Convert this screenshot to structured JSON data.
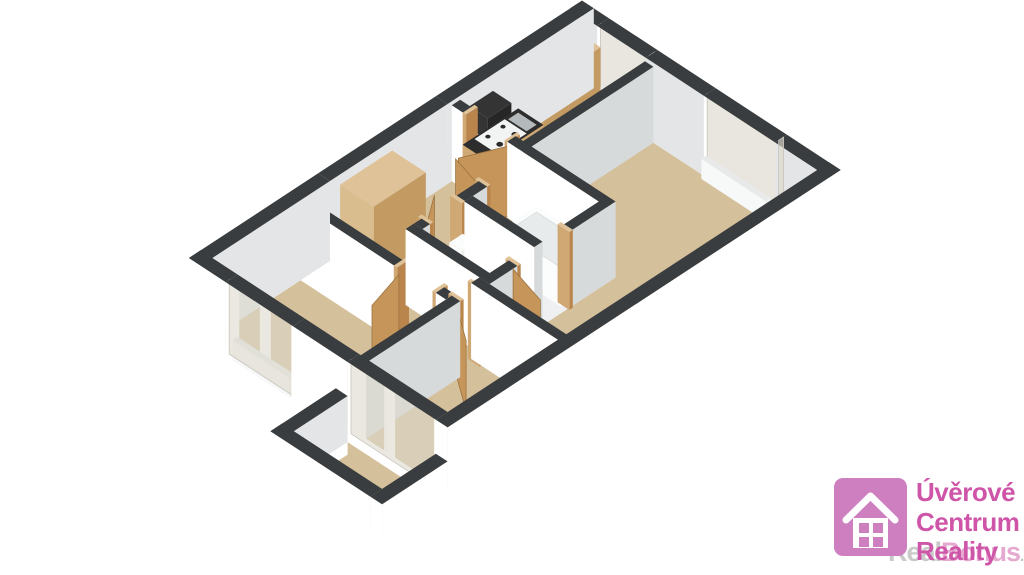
{
  "logo": {
    "line1": "Úvěrové",
    "line2": "Centrum",
    "line3": "Reality",
    "watermark_real": "Real",
    "watermark_bonus": "Bonus",
    "watermark_tld": ".cz"
  },
  "icons": {
    "house": "house-icon"
  },
  "scene": {
    "description": "3D axonometric floor plan of a three-room apartment with kitchen, bathroom, WC, hall, living room, two bedrooms and a balcony"
  },
  "colors": {
    "bg": "#ffffff",
    "floor": "#d5c09c",
    "bathFloor": "#eef0f1",
    "wallTop": "#3a3d3f",
    "wallWhite": "#ffffff",
    "wallLight": "#f4f5f5",
    "wallGray": "#d7dadb",
    "wallInner": "#e3e5e6",
    "glass": "#dcd8cc",
    "glassStroke": "#c7c4bb",
    "frame": "#ffffff",
    "wood": "#cfa874",
    "woodFront": "#c29a62",
    "woodTop": "#dfc298",
    "wardrobe": "#d9bd8e",
    "door": "#c6955a",
    "doorEdge": "#9c7340",
    "jamb": "#b9854d",
    "counterTop": "#2d2d2d",
    "applianceDark": "#343434",
    "applianceFront": "#262626",
    "cabGlass": "#4a3b2a",
    "fixtureWhite": "#fbfcfc",
    "fixtureSide": "#eef1f1",
    "tubInner": "#e7ebec",
    "sinkSteel": "#b4b9bb",
    "radiator": "#f0f2f2",
    "accentPink": "#cd7fc0",
    "textPink": "#cf55a9",
    "wmGray": "#c9c9c9",
    "wmPink": "#e5a8ce",
    "wmTldGray": "#bfbfbf"
  }
}
